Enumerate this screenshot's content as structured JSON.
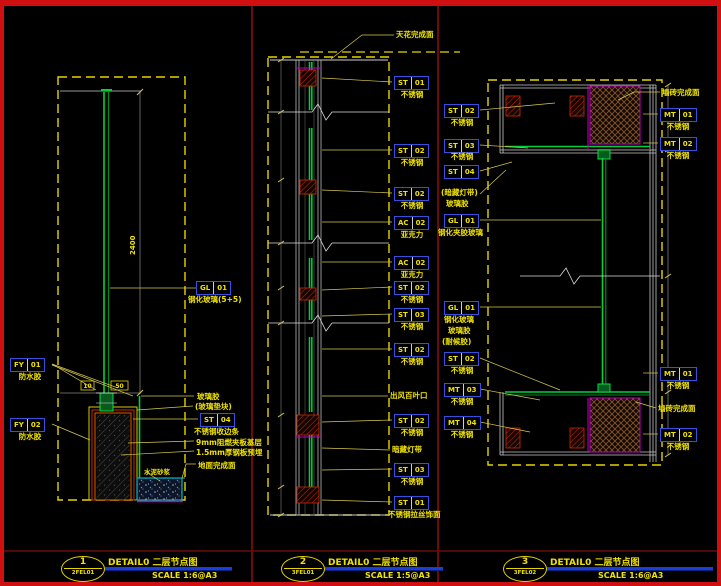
{
  "colors": {
    "background": "#000000",
    "frame_red": "#d01010",
    "separator_maroon": "#6e0a0a",
    "dashed_border_yellow": "#e8d400",
    "tag_border_blue": "#3550e0",
    "glass_green": "#00d23c",
    "magenta": "#c400c4",
    "cyan_box": "#00b7c8",
    "title_bar_blue": "#1b3fd6",
    "label_yellow": "#f0e200"
  },
  "titles": [
    {
      "num": "1",
      "ref": "2FEL01",
      "title": "DETAIL0 二层节点图",
      "scale": "SCALE 1:6@A3"
    },
    {
      "num": "2",
      "ref": "3FEL01",
      "title": "DETAIL0 二层节点图",
      "scale": "SCALE 1:5@A3"
    },
    {
      "num": "3",
      "ref": "3FEL02",
      "title": "DETAIL0 二层节点图",
      "scale": "SCALE 1:6@A3"
    }
  ],
  "p1": {
    "fy1": {
      "code": "FY",
      "num": "01",
      "cap": "防水胶"
    },
    "fy2": {
      "code": "FY",
      "num": "02",
      "cap": "防水胶"
    },
    "gl": {
      "code": "GL",
      "num": "01",
      "cap": "钢化玻璃(5+5)"
    },
    "glue": "玻璃胶",
    "pad": "(玻璃垫块)",
    "st04": {
      "code": "ST",
      "num": "04",
      "cap": "不锈钢收边条"
    },
    "board": "9mm阻燃夹板基层",
    "steel": "1.5mm厚钢板预埋",
    "floor": "地面完成面",
    "mortar": "水泥砂浆",
    "dim_a": "10",
    "dim_b": "50",
    "dim_h": "2400"
  },
  "p2": {
    "ceiling": "天花完成面",
    "g1": {
      "code": "ST",
      "num": "01",
      "cap": "不锈钢"
    },
    "g2": {
      "code": "ST",
      "num": "02",
      "cap": "不锈钢"
    },
    "g3": {
      "code": "ST",
      "num": "02",
      "cap": "不锈钢"
    },
    "g4": {
      "code": "AC",
      "num": "02",
      "cap": "亚克力"
    },
    "g5": {
      "code": "AC",
      "num": "02",
      "cap": "亚克力"
    },
    "g6": {
      "code": "ST",
      "num": "02",
      "cap": "不锈钢"
    },
    "g7": {
      "code": "ST",
      "num": "03",
      "cap": "不锈钢"
    },
    "g8": {
      "code": "ST",
      "num": "02",
      "cap": "不锈钢"
    },
    "vent": "出风百叶口",
    "g9": {
      "code": "ST",
      "num": "02",
      "cap": "不锈钢"
    },
    "light": "暗藏灯带",
    "g10": {
      "code": "ST",
      "num": "03",
      "cap": "不锈钢"
    },
    "g11": {
      "code": "ST",
      "num": "01",
      "cap": "不锈钢拉丝饰面"
    }
  },
  "p3": {
    "l1": {
      "code": "ST",
      "num": "02",
      "cap": "不锈钢"
    },
    "l2": {
      "code": "ST",
      "num": "03",
      "cap": "不锈钢"
    },
    "l3": {
      "code": "ST",
      "num": "04",
      "cap1": "(暗藏灯带)",
      "cap2": "玻璃胶"
    },
    "l4": {
      "code": "GL",
      "num": "01",
      "cap": "钢化夹胶玻璃"
    },
    "l5": {
      "code": "GL",
      "num": "01",
      "cap1": "钢化玻璃",
      "cap2": "玻璃胶",
      "cap3": "(耐候胶)"
    },
    "l6": {
      "code": "ST",
      "num": "02",
      "cap": "不锈钢"
    },
    "l7": {
      "code": "MT",
      "num": "03",
      "cap": "不锈钢"
    },
    "l8": {
      "code": "MT",
      "num": "04",
      "cap": "不锈钢"
    },
    "wall_top": "墙砖完成面",
    "r1": {
      "code": "MT",
      "num": "01",
      "cap": "不锈钢"
    },
    "r2": {
      "code": "MT",
      "num": "02",
      "cap": "不锈钢"
    },
    "r3": {
      "code": "MT",
      "num": "01",
      "cap": "不锈钢"
    },
    "wall_mid": "墙砖完成面",
    "r4": {
      "code": "MT",
      "num": "02",
      "cap": "不锈钢"
    }
  }
}
